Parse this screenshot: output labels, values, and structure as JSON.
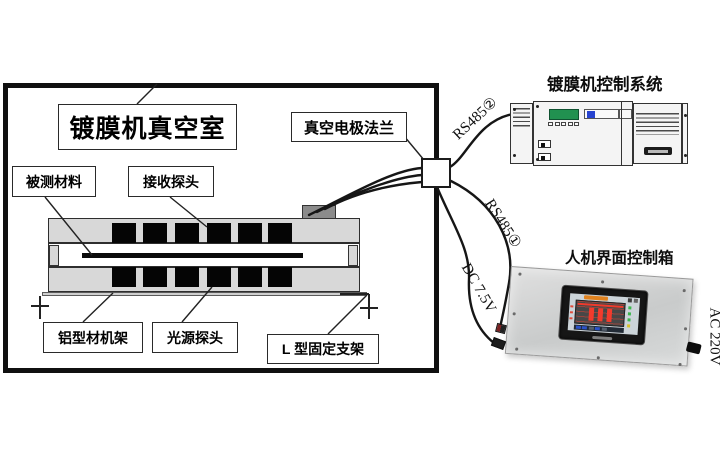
{
  "window": {
    "width": 726,
    "height": 450,
    "background": "#ffffff"
  },
  "chamber": {
    "title": "镀膜机真空室",
    "labels": {
      "flange": "真空电极法兰",
      "material": "被测材料",
      "receiver_probe": "接收探头",
      "frame": "铝型材机架",
      "light_probe": "光源探头",
      "bracket": "L 型固定支架"
    }
  },
  "control_system": {
    "title": "镀膜机控制系统"
  },
  "hmi": {
    "title": "人机界面控制箱"
  },
  "connections": {
    "rs485_2": "RS485②",
    "rs485_1": "RS485①",
    "dc_power": "DC 7.5V",
    "ac_power": "AC 220V"
  },
  "colors": {
    "wire": "#1a1a1a",
    "machine_gray": "#d8d8d8",
    "probe_black": "#050505",
    "feedthrough_gray": "#8b8b8b",
    "plc_display_green": "#219150",
    "plc_indicator_blue": "#2743cf",
    "hmi_bar_red": "#f23b2d",
    "hmi_led_green": "#3cb84e",
    "panel_metal": "#d3d5d5"
  }
}
